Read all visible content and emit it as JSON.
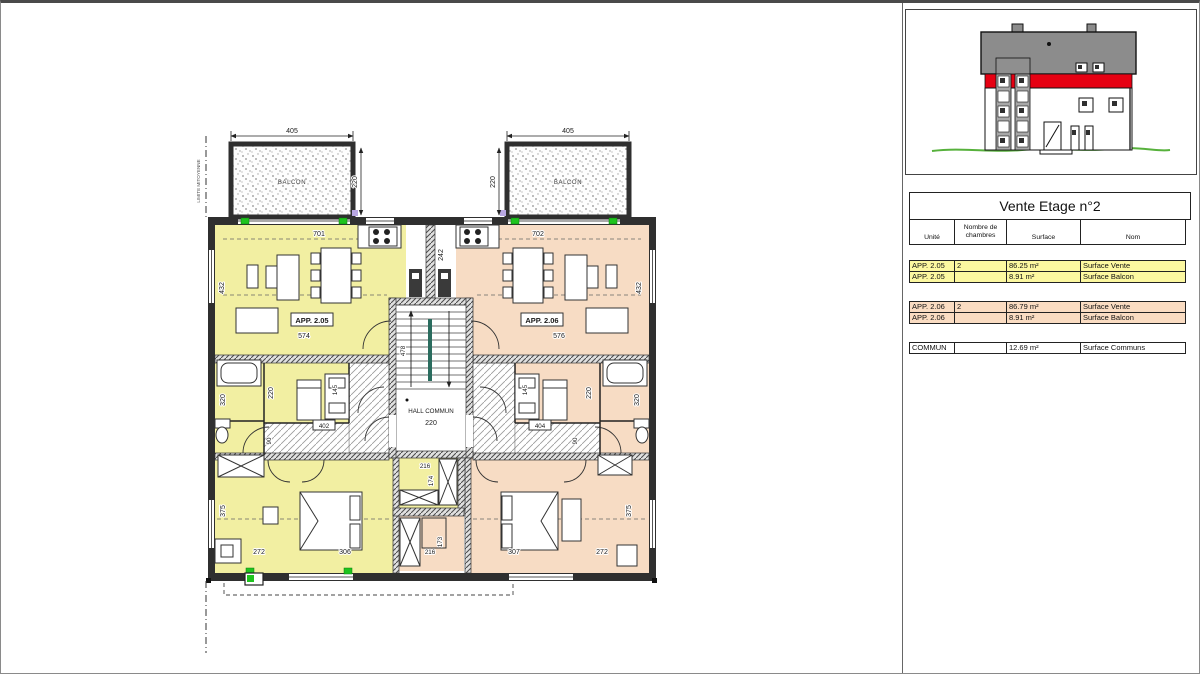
{
  "sheet": {
    "bg": "#ffffff"
  },
  "colors": {
    "apartment_left_fill": "#f2efa2",
    "apartment_right_fill": "#f7dcc4",
    "table_yellow": "#fcf8a0",
    "table_peach": "#fadcc2",
    "table_white": "#ffffff",
    "wall_dark": "#2f2f2f",
    "roof_gray": "#8c8c8c",
    "band_red": "#e60012",
    "ground_green": "#57b13c",
    "marker_green": "#1ec41e"
  },
  "plan": {
    "rooms": {
      "balcon_left": "BALCON",
      "balcon_right": "BALCON",
      "app_left": "APP. 2.05",
      "app_right": "APP. 2.06",
      "hall": "HALL COMMUN",
      "limite": "LIMITE MITOYENNE"
    },
    "dims": {
      "balcony_left_w": "405",
      "balcony_right_w": "405",
      "balcony_left_d": "220",
      "balcony_right_d": "220",
      "living_left_top": "701",
      "living_right_top": "702",
      "kitchen_depth": "242",
      "living_left_side": "432",
      "living_right_side": "432",
      "living_left_w": "574",
      "living_right_w": "576",
      "stair_len": "478",
      "hall_w": "220",
      "bath_left": "320",
      "bed2_left": "220",
      "closet_left": "145",
      "door_left": "402",
      "corr_left": "90",
      "bath_right": "320",
      "bed2_right": "220",
      "closet_right": "145",
      "door_right": "404",
      "corr_right": "90",
      "center_w_top": "216",
      "center_h_top": "174",
      "center_h_bot": "173",
      "center_w_bot": "216",
      "bed1_left_a": "272",
      "bed1_left_b": "306",
      "bed1_right_a": "307",
      "bed1_right_b": "272",
      "bed1_left_side": "375",
      "bed1_right_side": "375"
    }
  },
  "table": {
    "title": "Vente Etage n°2",
    "headers": [
      "Unité",
      "Nombre de chambres",
      "Surface",
      "Nom"
    ],
    "groups": [
      {
        "bg": "#fcf8a0",
        "rows": [
          [
            "APP. 2.05",
            "2",
            "86.25 m²",
            "Surface Vente"
          ],
          [
            "APP. 2.05",
            "",
            "8.91 m²",
            "Surface Balcon"
          ]
        ]
      },
      {
        "bg": "#fadcc2",
        "rows": [
          [
            "APP. 2.06",
            "2",
            "86.79 m²",
            "Surface Vente"
          ],
          [
            "APP. 2.06",
            "",
            "8.91 m²",
            "Surface Balcon"
          ]
        ]
      },
      {
        "bg": "#ffffff",
        "rows": [
          [
            "COMMUN",
            "",
            "12.69 m²",
            "Surface Communs"
          ]
        ]
      }
    ]
  }
}
